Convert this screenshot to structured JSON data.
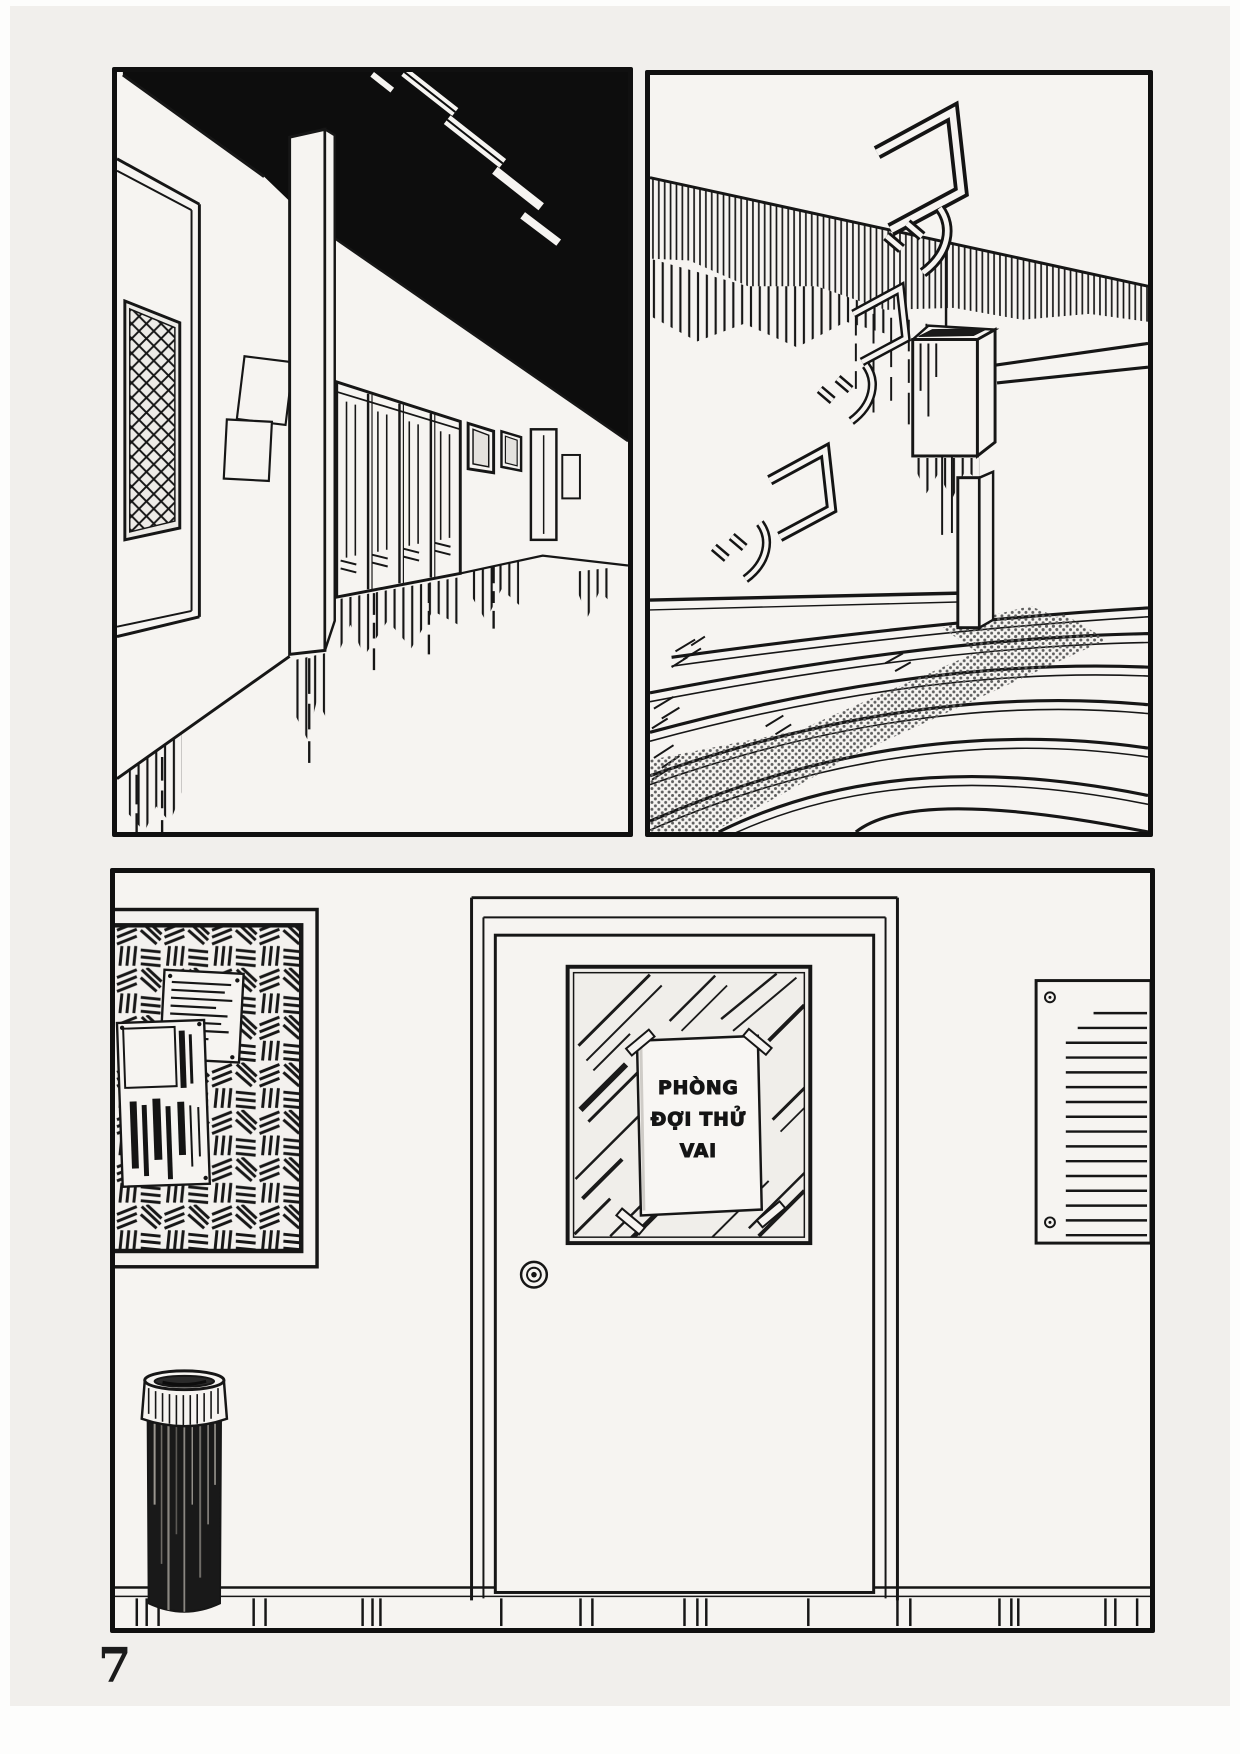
{
  "page": {
    "number": "7"
  },
  "colors": {
    "paper": "#f1efec",
    "panel_bg": "#f6f4f1",
    "ink": "#161616",
    "black_fill": "#0d0d0d",
    "tone_dot": "#5e5e5e"
  },
  "panels": {
    "hallway": {
      "description": "Dark corridor with a latticed door, wall posters, pillar and lockers"
    },
    "stairway": {
      "description": "Stairwell with wall-mounted dustbin and footstep sound effects",
      "sfx": [
        "コッ",
        "コッ",
        "コッ"
      ]
    },
    "waiting_room": {
      "description": "Hallway with notice board, vent, standing ashtray and the audition waiting room door",
      "door_sign": {
        "lines": [
          "PHÒNG",
          "ĐỢI THỬ",
          "VAI"
        ]
      }
    }
  }
}
